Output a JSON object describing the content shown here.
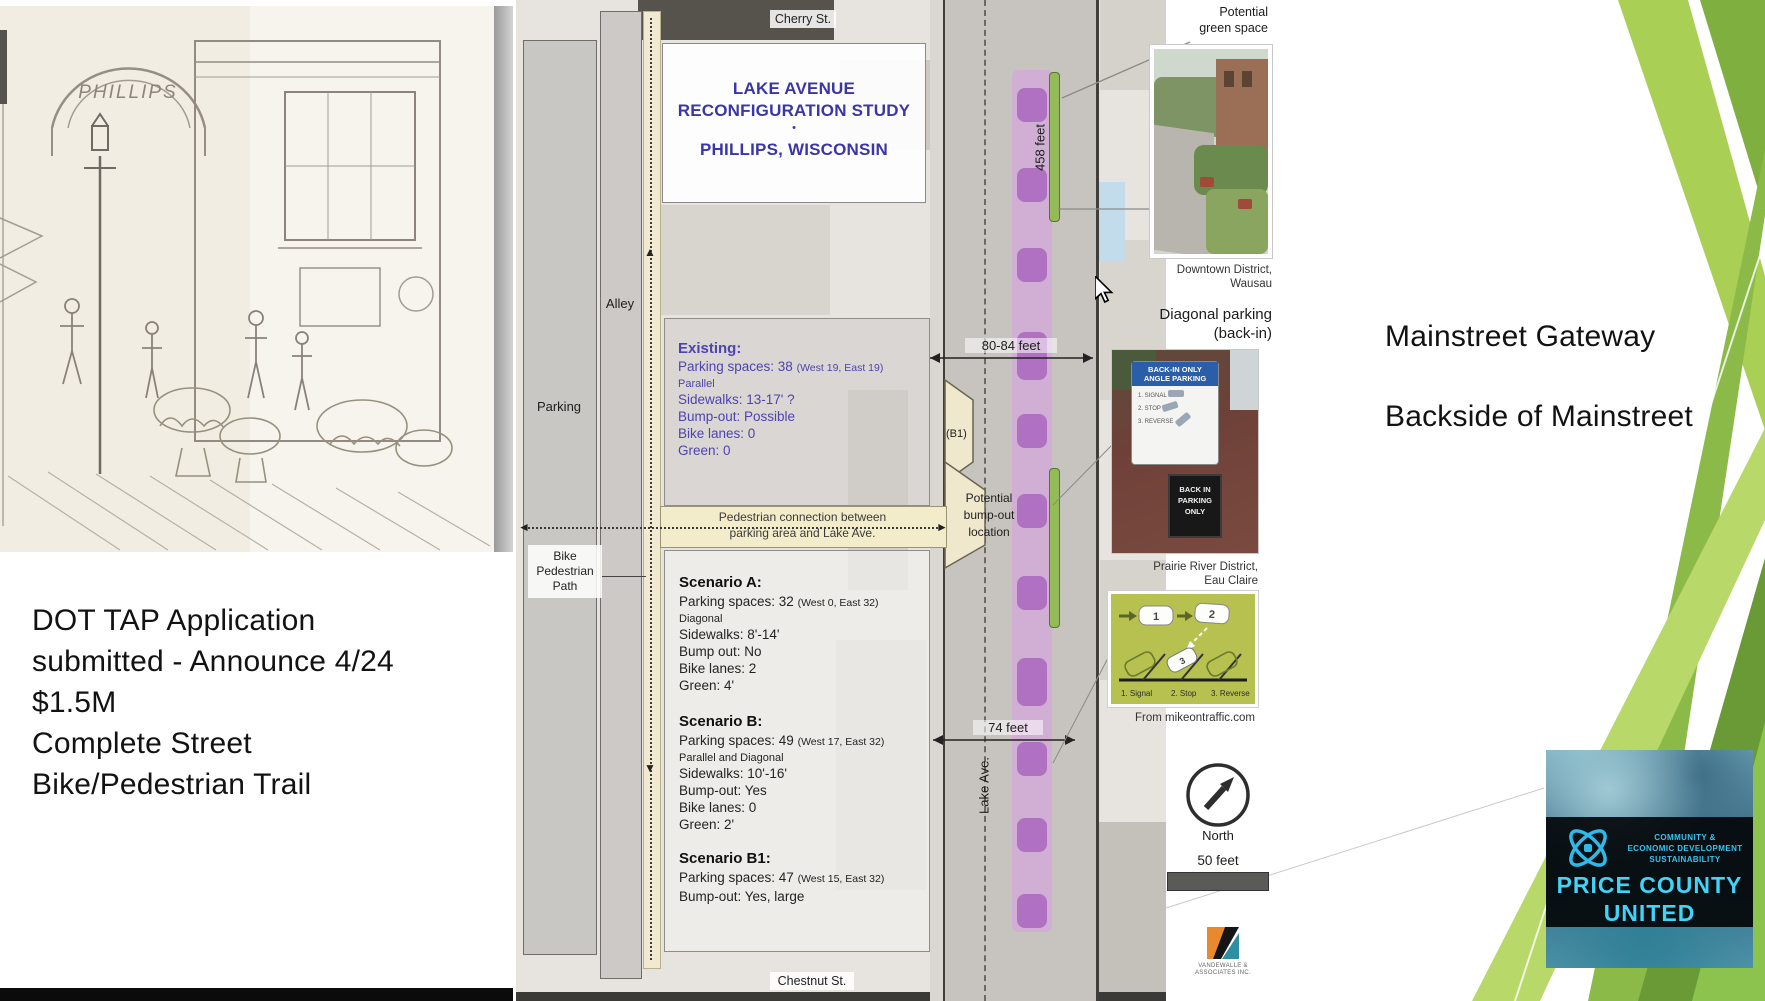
{
  "slide": {
    "deck_notes_left": [
      "DOT TAP Application",
      "submitted - Announce 4/24",
      "$1.5M",
      "Complete Street",
      "Bike/Pedestrian Trail"
    ],
    "notes_right": [
      "Mainstreet Gateway",
      "Backside of Mainstreet"
    ],
    "sketch_caption": "PHILLIPS"
  },
  "map": {
    "title": {
      "l1": "LAKE AVENUE",
      "l2": "RECONFIGURATION STUDY",
      "dot": "•",
      "l3": "PHILLIPS, WISCONSIN"
    },
    "street_top": "Cherry St.",
    "street_bottom": "Chestnut St.",
    "street_main": "Lake Ave.",
    "alley": "Alley",
    "parking": "Parking",
    "bike_path_l1": "Bike",
    "bike_path_l2": "Pedestrian",
    "bike_path_l3": "Path",
    "banner_l1": "Pedestrian connection between",
    "banner_l2": "parking area and Lake Ave.",
    "green_space_l1": "Potential",
    "green_space_l2": "green space",
    "bump_l1": "Potential",
    "bump_l2": "bump-out",
    "bump_l3": "location",
    "b1": "(B1)",
    "m_len": "458 feet",
    "m_w1": "80-84 feet",
    "m_w2": "74 feet",
    "existing": {
      "h": "Existing:",
      "r0m": "Parking spaces: 38",
      "r0n": "(West 19, East 19)",
      "r1": "Parallel",
      "r2": "Sidewalks: 13-17' ?",
      "r3": "Bump-out: Possible",
      "r4": "Bike lanes: 0",
      "r5": "Green: 0"
    },
    "sa": {
      "h": "Scenario A:",
      "r0m": "Parking spaces: 32",
      "r0n": "(West 0, East 32)",
      "r1": "Diagonal",
      "r2": "Sidewalks: 8'-14'",
      "r3": "Bump out: No",
      "r4": "Bike lanes: 2",
      "r5": "Green: 4'"
    },
    "sb": {
      "h": "Scenario B:",
      "r0m": "Parking spaces: 49",
      "r0n": "(West 17, East 32)",
      "r1": "Parallel and Diagonal",
      "r2": "Sidewalks: 10'-16'",
      "r3": "Bump-out: Yes",
      "r4": "Bike lanes: 0",
      "r5": "Green: 2'"
    },
    "sb1": {
      "h": "Scenario B1:",
      "r0m": "Parking spaces: 47",
      "r0n": "(West 15, East 32)",
      "r1": "Bump-out: Yes, large"
    },
    "north": "North",
    "scale": "50 feet",
    "vendor": "VANDEWALLE & ASSOCIATES INC."
  },
  "photos": {
    "cap1_l1": "Downtown District,",
    "cap1_l2": "Wausau",
    "diag_l1": "Diagonal parking",
    "diag_l2": "(back-in)",
    "sign_top_l1": "BACK-IN ONLY",
    "sign_top_l2": "ANGLE PARKING",
    "sign_items": [
      "1. SIGNAL",
      "2. STOP",
      "3. REVERSE"
    ],
    "sign_bottom_l1": "BACK IN",
    "sign_bottom_l2": "PARKING",
    "sign_bottom_l3": "ONLY",
    "cap2_l1": "Prairie River District,",
    "cap2_l2": "Eau Claire",
    "car1": "1",
    "car2": "2",
    "car3": "3",
    "step1": "1. Signal",
    "step2": "2. Stop",
    "step3": "3. Reverse",
    "source": "From mikeontraffic.com"
  },
  "logo": {
    "t1": "COMMUNITY &",
    "t2": "ECONOMIC DEVELOPMENT",
    "t3": "SUSTAINABILITY",
    "n1": "PRICE COUNTY",
    "n2": "UNITED"
  },
  "colors": {
    "accent_purple": "#3b36a8",
    "existing_purple": "#4f43b0",
    "pink_lane": "#d6a0de",
    "green_strip": "#93bb57",
    "slide_green_light": "#b9d86a",
    "slide_green_dark": "#699a35",
    "logo_cyan": "#3fd0f5"
  }
}
